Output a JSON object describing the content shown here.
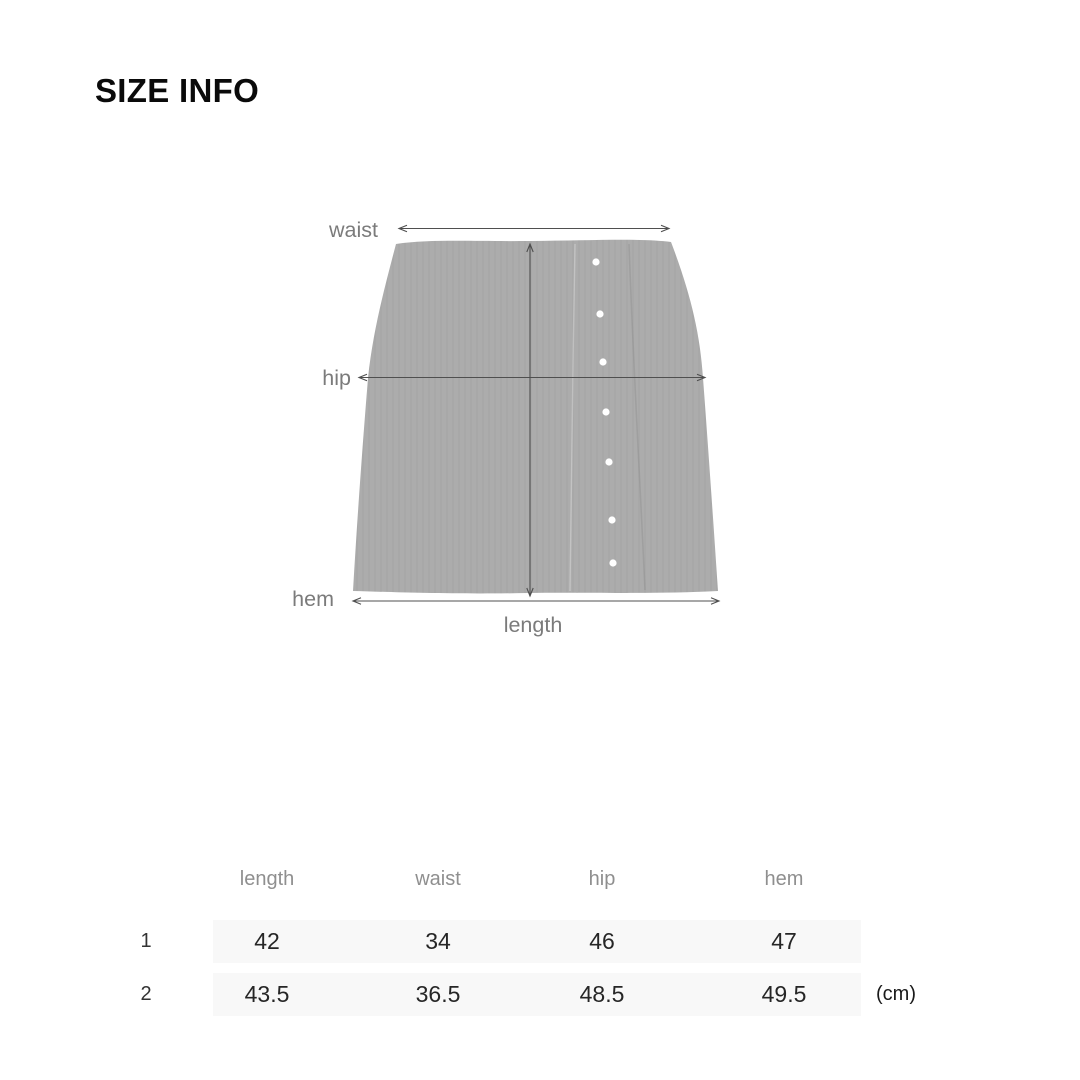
{
  "title": "SIZE INFO",
  "diagram": {
    "labels": {
      "waist": "waist",
      "hip": "hip",
      "hem": "hem",
      "length": "length"
    },
    "colors": {
      "garment_fill": "#acacac",
      "measure_line": "#4f4f4f",
      "label_text": "#7b7b7b",
      "button": "#ffffff"
    }
  },
  "size_table": {
    "headers": [
      "length",
      "waist",
      "hip",
      "hem"
    ],
    "rows": [
      {
        "label": "1",
        "values": [
          "42",
          "34",
          "46",
          "47"
        ]
      },
      {
        "label": "2",
        "values": [
          "43.5",
          "36.5",
          "48.5",
          "49.5"
        ]
      }
    ],
    "unit": "(cm)",
    "colors": {
      "row_band": "#f8f8f8",
      "header_text": "#8f8f8f",
      "value_text": "#262626"
    }
  }
}
